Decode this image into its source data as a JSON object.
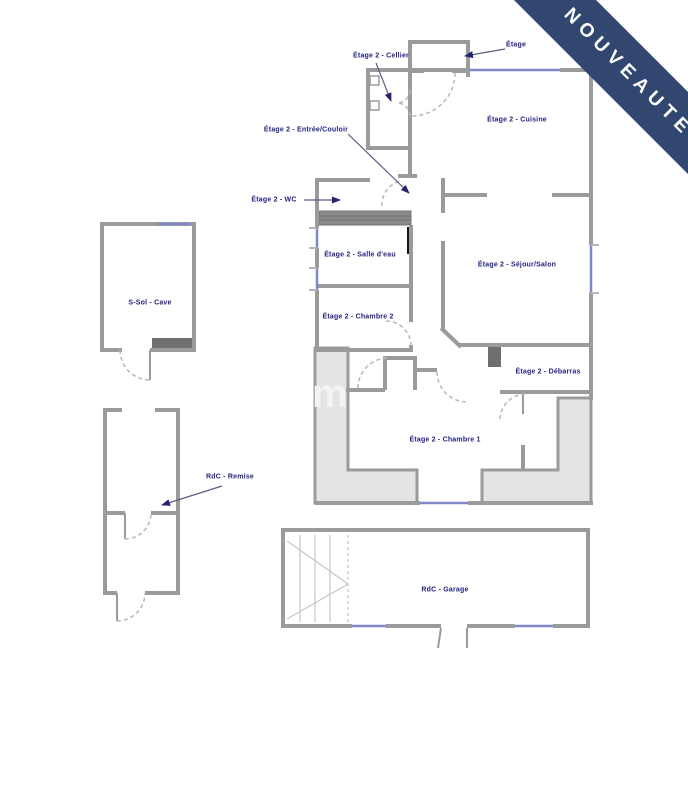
{
  "banner": {
    "text": "NOUVEAUTE"
  },
  "watermark": {
    "text": "m"
  },
  "plan": {
    "labels": {
      "cellier": "Étage 2 - Cellier",
      "top_partial": "Étage",
      "cuisine": "Étage 2 - Cuisine",
      "entree_couloir": "Étage 2 - Entrée/Couloir",
      "wc": "Étage 2 - WC",
      "salle_deau": "Étage 2 - Salle d'eau",
      "sejour_salon": "Étage 2 - Séjour/Salon",
      "chambre2": "Étage 2 - Chambre 2",
      "debarras": "Étage 2 - Débarras",
      "chambre1": "Étage 2 - Chambre 1",
      "cave": "S-Sol - Cave",
      "remise": "RdC - Remise",
      "garage": "RdC - Garage"
    }
  },
  "colors": {
    "ribbon_bg": "#314770",
    "ribbon_text": "#ffffff",
    "label_text": "#24227f",
    "wall": "#9b9b9b",
    "window": "#8287c8",
    "terrace_fill": "#e4e4e4",
    "stair_block": "#8a8a8a",
    "arrow": "#5c5c82"
  }
}
